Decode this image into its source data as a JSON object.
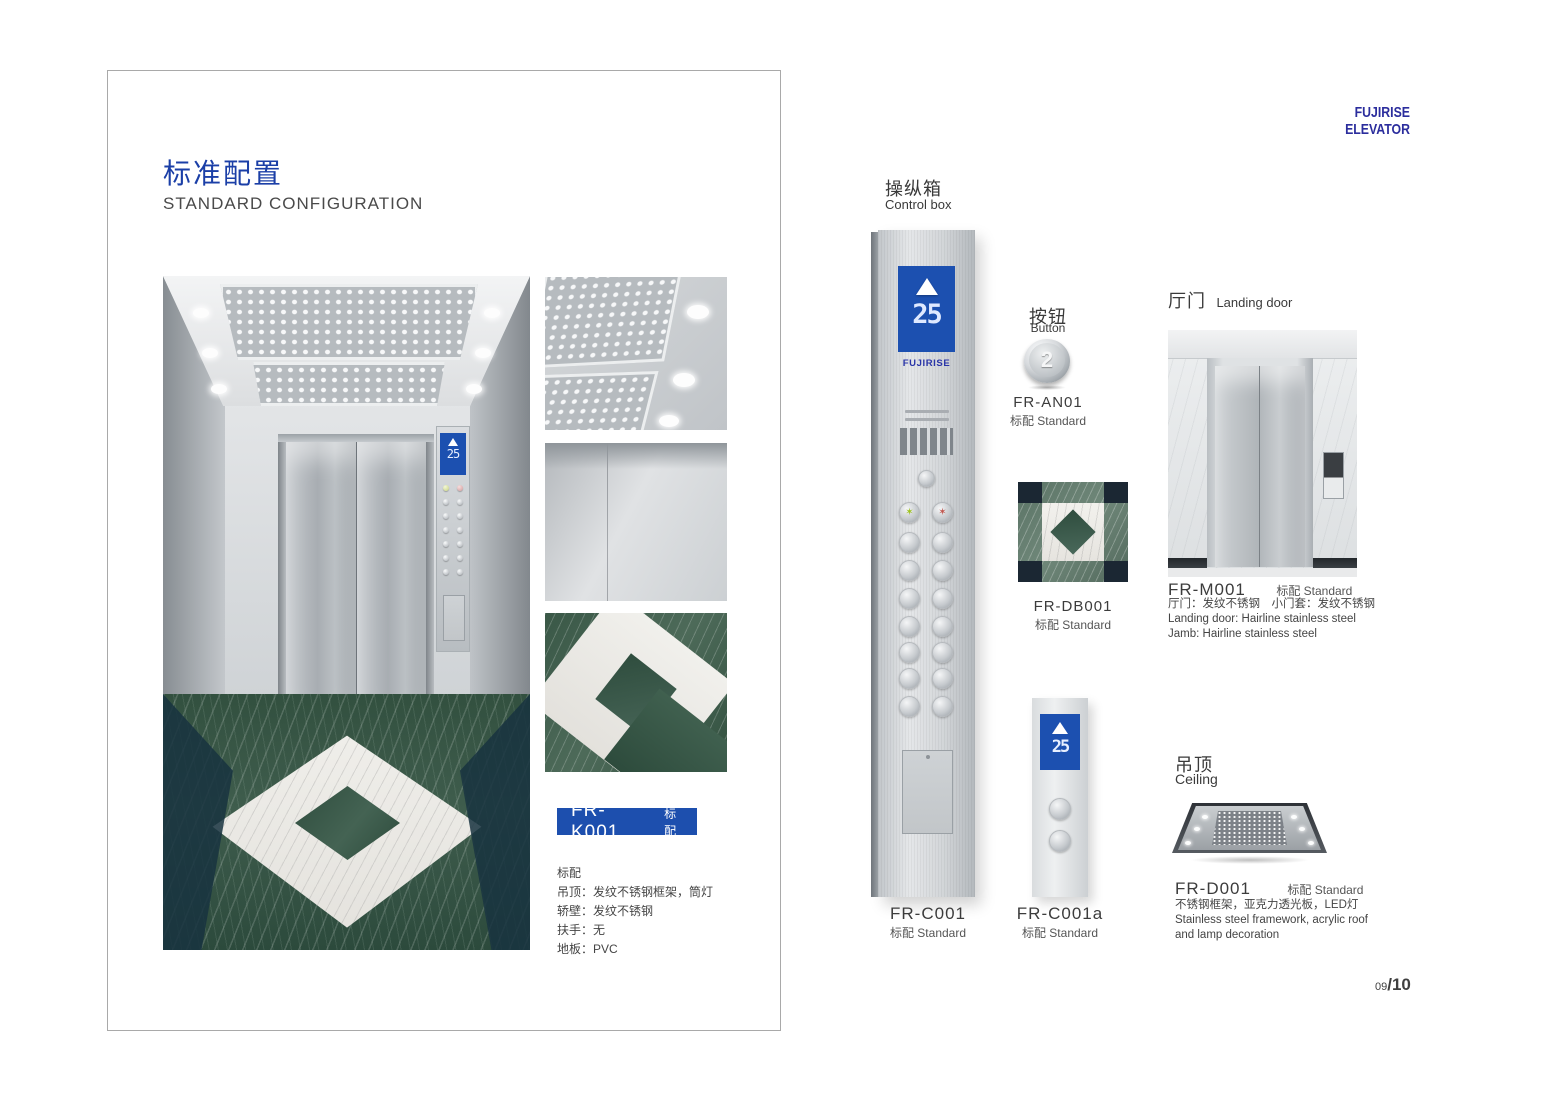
{
  "brand": {
    "logo": "FUJIRISE ELEVATOR"
  },
  "page": {
    "number": "09",
    "total": "/10"
  },
  "left": {
    "title_zh": "标准配置",
    "title_en": "STANDARD CONFIGURATION",
    "model_bar": {
      "model": "FR-K001",
      "tag": "标配"
    },
    "specs": [
      "标配",
      "吊顶：发纹不锈钢框架，筒灯",
      "轿壁：发纹不锈钢",
      "扶手：无",
      "地板：PVC"
    ],
    "cab": {
      "display_floor": "25"
    }
  },
  "control_box": {
    "title_zh": "操纵箱",
    "title_en": "Control box",
    "display_floor": "25",
    "display_brand": "FUJIRISE",
    "model": "FR-C001",
    "tag": "标配 Standard"
  },
  "button": {
    "title_zh": "按钮",
    "title_en": "Button",
    "glyph": "2",
    "model": "FR-AN01",
    "tag": "标配 Standard"
  },
  "floor_tile": {
    "model": "FR-DB001",
    "tag": "标配 Standard"
  },
  "hall_station": {
    "model": "FR-C001a",
    "tag": "标配 Standard",
    "display_floor": "25"
  },
  "landing_door": {
    "title_zh": "厅门",
    "title_en": "Landing door",
    "model": "FR-M001",
    "tag": "标配 Standard",
    "desc": [
      "厅门：发纹不锈钢　小门套：发纹不锈钢",
      "Landing door: Hairline stainless steel",
      "Jamb: Hairline stainless steel"
    ]
  },
  "ceiling": {
    "title_zh": "吊顶",
    "title_en": "Ceiling",
    "model": "FR-D001",
    "tag": "标配 Standard",
    "desc": [
      "不锈钢框架，亚克力透光板，LED灯",
      "Stainless steel framework, acrylic roof",
      "and lamp decoration"
    ]
  }
}
